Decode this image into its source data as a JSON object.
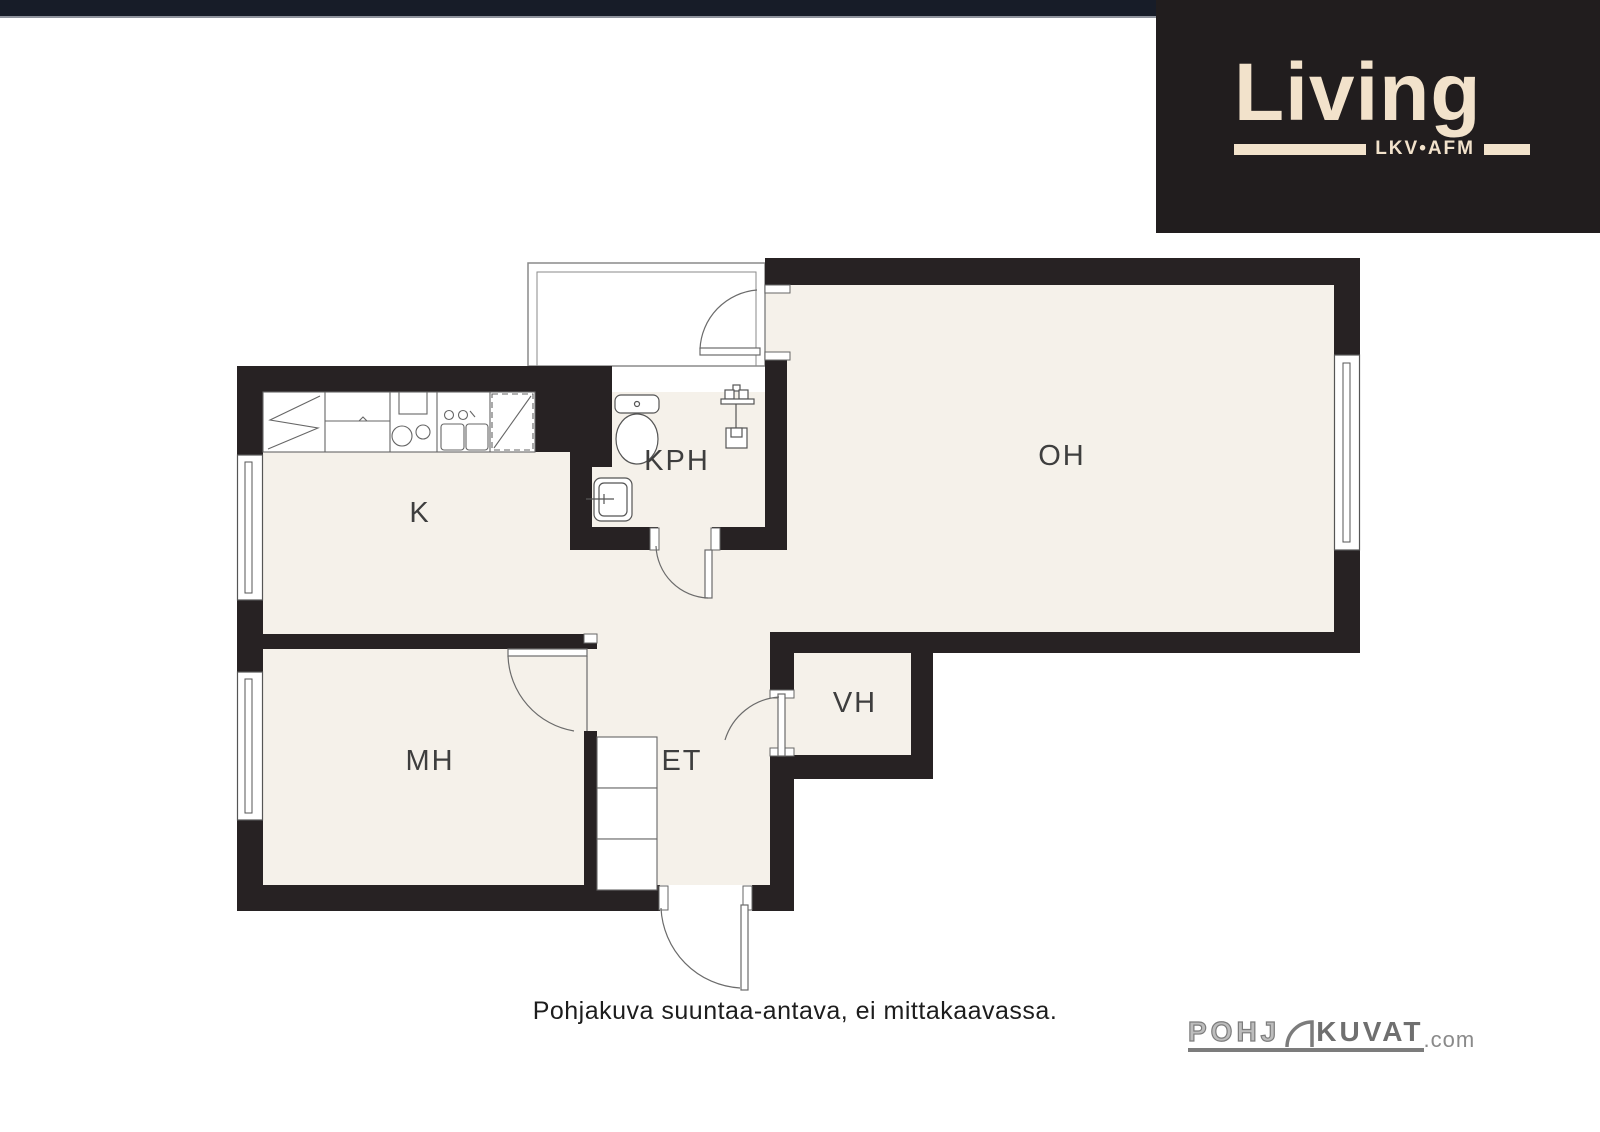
{
  "page": {
    "background": "#ffffff",
    "top_bar_color": "#171c28"
  },
  "brand": {
    "name": "Living",
    "tagline": "LKV•AFM",
    "panel_bg": "#211d1e",
    "text_color": "#f2e2cb"
  },
  "plan": {
    "wall_color": "#272223",
    "floor_color": "#f5f1ea",
    "line_color": "#666666",
    "label_color": "#3e3e3e",
    "rooms": [
      {
        "id": "oh",
        "name": "living-room",
        "label": "OH"
      },
      {
        "id": "k",
        "name": "kitchen",
        "label": "K"
      },
      {
        "id": "kph",
        "name": "bathroom",
        "label": "KPH"
      },
      {
        "id": "mh",
        "name": "bedroom",
        "label": "MH"
      },
      {
        "id": "et",
        "name": "entry-hall",
        "label": "ET"
      },
      {
        "id": "vh",
        "name": "closet",
        "label": "VH"
      }
    ],
    "fixtures": [
      "fridge",
      "stove",
      "kitchen-sink",
      "dishwasher",
      "toilet",
      "shower",
      "washbasin",
      "wardrobe",
      "balcony",
      "windows",
      "doors"
    ]
  },
  "footer": {
    "disclaimer": "Pohjakuva suuntaa-antava, ei mittakaavassa.",
    "logo": {
      "prefix": "POHJ",
      "main": "KUVAT",
      "suffix": ".com"
    }
  }
}
